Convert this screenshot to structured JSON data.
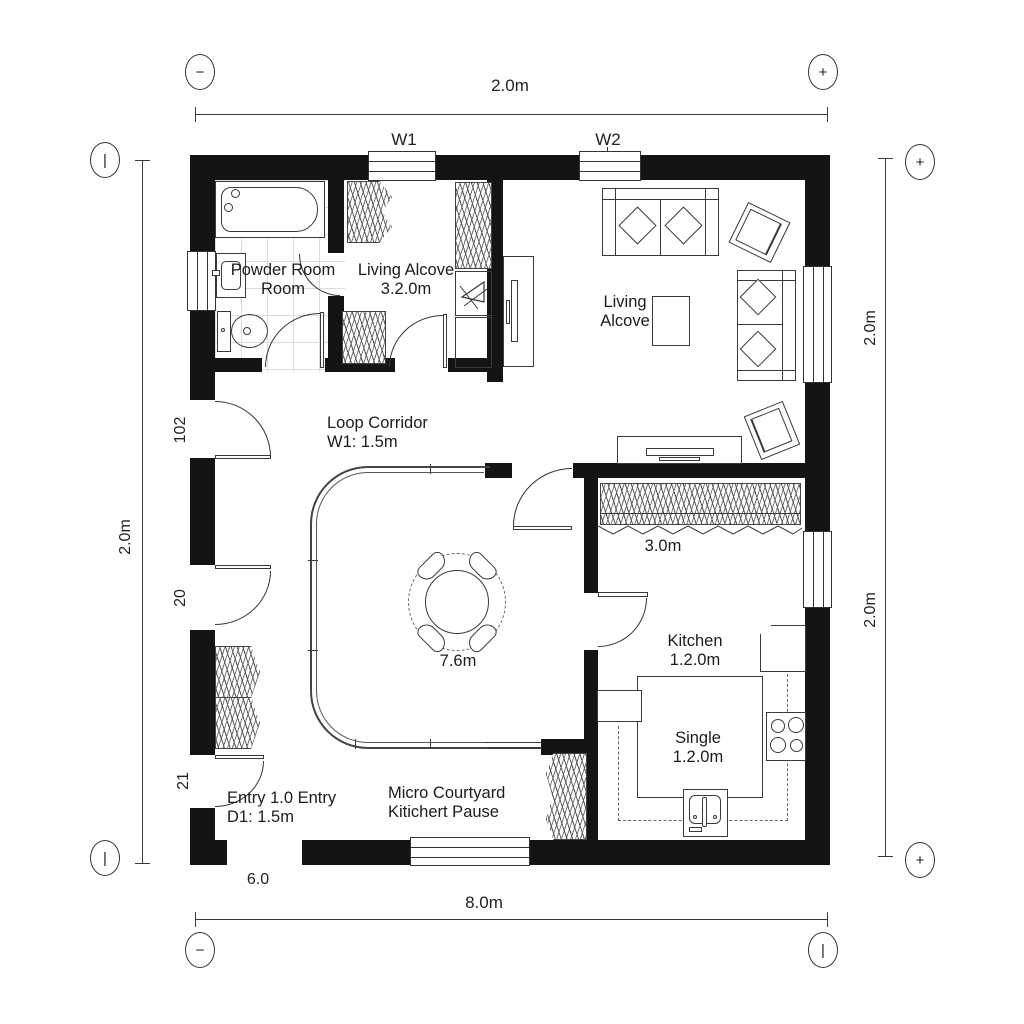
{
  "plan": {
    "dims": {
      "top": "2.0m",
      "bottom": "8.0m",
      "left": "2.0m",
      "right_top": "2.0m",
      "right_bottom": "2.0m"
    },
    "wall_tags": {
      "w1": "W1",
      "w2": "W2"
    },
    "opening_tags": {
      "left_top": "102",
      "left_mid": "20",
      "left_bottom": "21",
      "bottom": "6.0"
    },
    "bubbles": {
      "top_left": "−",
      "top_right": "+",
      "right_top": "+",
      "right_bottom": "+",
      "left_top": "|",
      "left_bottom": "|",
      "bottom_left": "−",
      "bottom_right": "|"
    },
    "rooms": {
      "powder": {
        "line1": "Powder Room",
        "line2": "Room"
      },
      "alcove_small": {
        "line1": "Living Alcove",
        "line2": "3.2.0m"
      },
      "living": {
        "line1": "Living",
        "line2": "Alcove"
      },
      "corridor": {
        "line1": "Loop Corridor",
        "line2": "W1: 1.5m"
      },
      "kitchen": {
        "line1": "Kitchen",
        "line2": "1.2.0m"
      },
      "single": {
        "line1": "Single",
        "line2": "1.2.0m"
      },
      "entry": {
        "line1": "Entry 1.0 Entry",
        "line2": "D1: 1.5m"
      },
      "courtyard": {
        "line1": "Micro Courtyard",
        "line2": "Kitichert Pause"
      },
      "wardrobe_dim": "3.0m",
      "table_dim": "7.6m"
    },
    "colors": {
      "wall": "#141414",
      "line": "#3a3a3a",
      "tile": "#dcdcdc",
      "bg": "#ffffff"
    }
  }
}
